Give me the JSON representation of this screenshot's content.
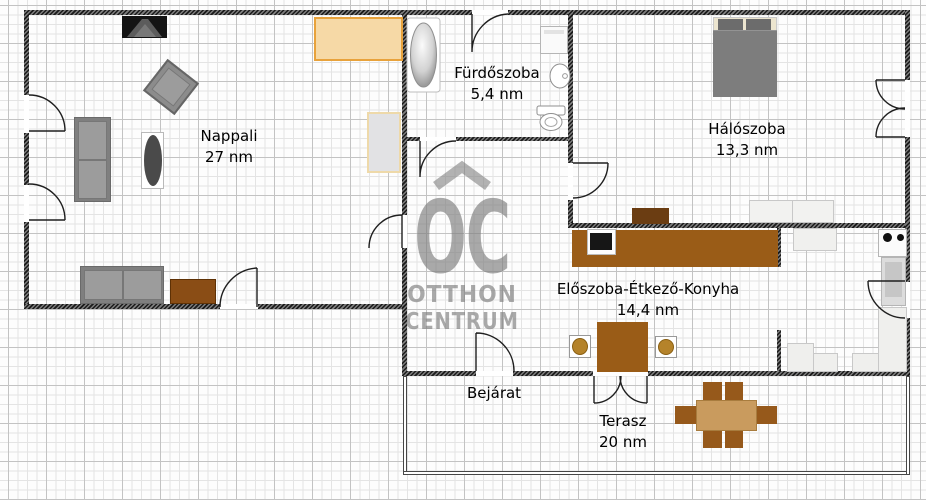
{
  "watermark": {
    "logo": "OC",
    "subtitle1": "OTTHON",
    "subtitle2": "CENTRUM"
  },
  "rooms": {
    "nappali": {
      "label": "Nappali",
      "area": "27 nm"
    },
    "furdoszoba": {
      "label": "Fürdőszoba",
      "area": "5,4 nm"
    },
    "haloszoba": {
      "label": "Hálószoba",
      "area": "13,3 nm"
    },
    "eloszoba": {
      "label": "Előszoba-Étkező-Konyha",
      "area": "14,4 nm"
    },
    "bejarat": {
      "label": "Bejárat"
    },
    "terasz": {
      "label": "Terasz",
      "area": "20 nm"
    }
  },
  "furniture_icons": [
    "tv-icon",
    "sideboard-icon",
    "armchair-icon",
    "sofa-icon",
    "coffee-table-icon",
    "wardrobe-icon",
    "cabinet-icon",
    "bathtub-icon",
    "washing-machine-icon",
    "sink-icon",
    "toilet-icon",
    "double-bed-icon",
    "dresser-icon",
    "bench-icon",
    "counter-icon",
    "laptop-icon",
    "dining-table-icon",
    "stool-icon",
    "stove-icon",
    "refrigerator-icon",
    "terrace-table-icon",
    "terrace-chair-icon",
    "door-arc-icon"
  ],
  "colors": {
    "wall": "#3a3a3a",
    "wood_dark": "#9a5c17",
    "wood_medium": "#8a4d15",
    "wood_light": "#c99b5e",
    "bench_orange_fill": "#f6d9a6",
    "bench_orange_border": "#e8a23b",
    "furniture_gray": "#8c8c8c",
    "watermark_gray": "#b0b0b0"
  }
}
